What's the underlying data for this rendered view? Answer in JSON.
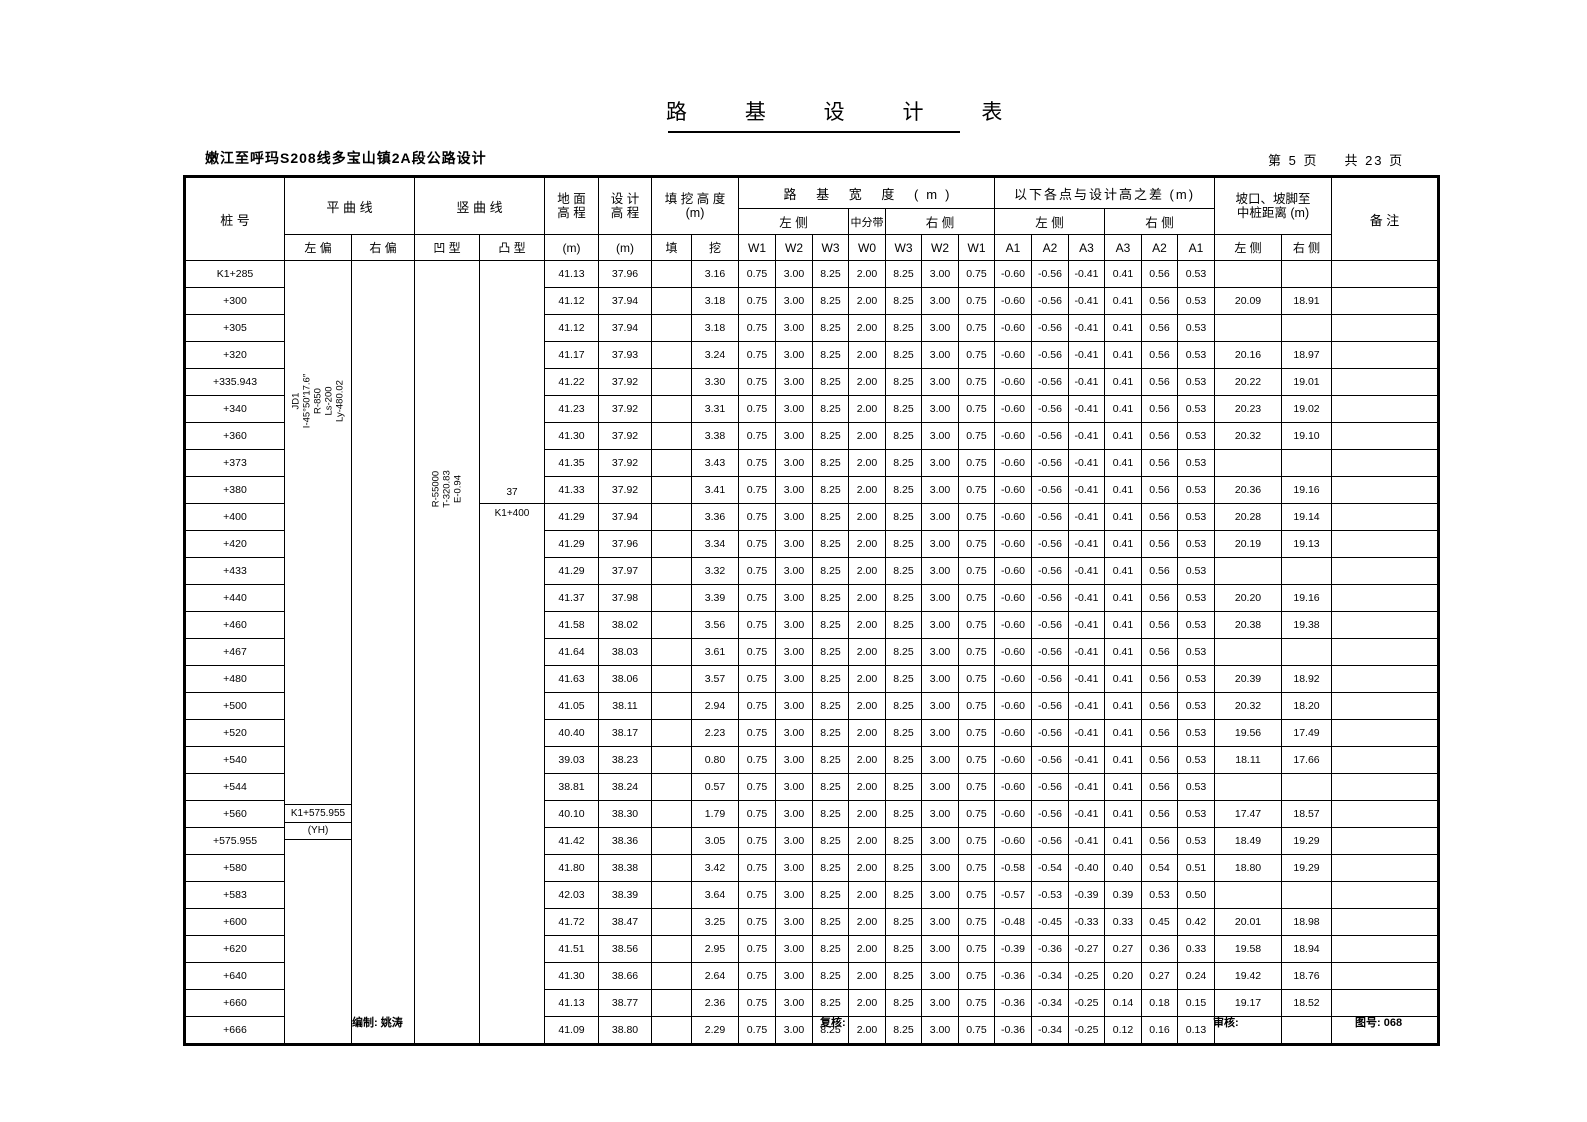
{
  "title": "路 基 设 计 表",
  "subtitle": "嫩江至呼玛S208线多宝山镇2A段公路设计",
  "page_info": {
    "page_label": "第 5 页",
    "total_label": "共 23 页"
  },
  "header": {
    "stake": "桩  号",
    "hcurve": "平  曲  线",
    "hcurve_left": "左 偏",
    "hcurve_right": "右 偏",
    "vcurve": "竖  曲  线",
    "vcurve_concave": "凹 型",
    "vcurve_convex": "凸 型",
    "ground_l1": "地  面",
    "ground_l2": "高  程",
    "ground_unit": "(m)",
    "design_l1": "设  计",
    "design_l2": "高  程",
    "design_unit": "(m)",
    "fillcut_l1": "填 挖 高 度",
    "fillcut_l2": "(m)",
    "fill": "填",
    "cut": "挖",
    "width_title": "路  基  宽  度  (m)",
    "side_left": "左  侧",
    "median": "中分带",
    "side_right": "右  侧",
    "w_labels": [
      "W1",
      "W2",
      "W3",
      "W0",
      "W3",
      "W2",
      "W1"
    ],
    "diff_title": "以下各点与设计高之差 (m)",
    "diff_left": "左  侧",
    "diff_right": "右  侧",
    "a_labels": [
      "A1",
      "A2",
      "A3",
      "A3",
      "A2",
      "A1"
    ],
    "slope_l1": "坡口、坡脚至",
    "slope_l2": "中桩距离 (m)",
    "slope_left": "左 侧",
    "slope_right": "右 侧",
    "remark": "备    注"
  },
  "annotations": {
    "hcurve_note": [
      "JD1",
      "I-45°50′17.6″",
      "R-850",
      "Ls-200",
      "Ly-480.02"
    ],
    "vcurve_note": [
      "R-55000",
      "T-320.83",
      "E-0.94"
    ],
    "convex_point": {
      "top": "37",
      "bottom": "K1+400"
    },
    "yh_point": {
      "top": "K1+575.955",
      "bottom": "(YH)"
    }
  },
  "w_common": [
    "0.75",
    "3.00",
    "8.25",
    "2.00",
    "8.25",
    "3.00",
    "0.75"
  ],
  "rows": [
    {
      "stake": "K1+285",
      "ground": "41.13",
      "design": "37.96",
      "fill": "",
      "cut": "3.16",
      "a": [
        "-0.60",
        "-0.56",
        "-0.41",
        "0.41",
        "0.56",
        "0.53"
      ],
      "dl": "",
      "dr": ""
    },
    {
      "stake": "+300",
      "ground": "41.12",
      "design": "37.94",
      "fill": "",
      "cut": "3.18",
      "a": [
        "-0.60",
        "-0.56",
        "-0.41",
        "0.41",
        "0.56",
        "0.53"
      ],
      "dl": "20.09",
      "dr": "18.91"
    },
    {
      "stake": "+305",
      "ground": "41.12",
      "design": "37.94",
      "fill": "",
      "cut": "3.18",
      "a": [
        "-0.60",
        "-0.56",
        "-0.41",
        "0.41",
        "0.56",
        "0.53"
      ],
      "dl": "",
      "dr": ""
    },
    {
      "stake": "+320",
      "ground": "41.17",
      "design": "37.93",
      "fill": "",
      "cut": "3.24",
      "a": [
        "-0.60",
        "-0.56",
        "-0.41",
        "0.41",
        "0.56",
        "0.53"
      ],
      "dl": "20.16",
      "dr": "18.97"
    },
    {
      "stake": "+335.943",
      "ground": "41.22",
      "design": "37.92",
      "fill": "",
      "cut": "3.30",
      "a": [
        "-0.60",
        "-0.56",
        "-0.41",
        "0.41",
        "0.56",
        "0.53"
      ],
      "dl": "20.22",
      "dr": "19.01"
    },
    {
      "stake": "+340",
      "ground": "41.23",
      "design": "37.92",
      "fill": "",
      "cut": "3.31",
      "a": [
        "-0.60",
        "-0.56",
        "-0.41",
        "0.41",
        "0.56",
        "0.53"
      ],
      "dl": "20.23",
      "dr": "19.02"
    },
    {
      "stake": "+360",
      "ground": "41.30",
      "design": "37.92",
      "fill": "",
      "cut": "3.38",
      "a": [
        "-0.60",
        "-0.56",
        "-0.41",
        "0.41",
        "0.56",
        "0.53"
      ],
      "dl": "20.32",
      "dr": "19.10"
    },
    {
      "stake": "+373",
      "ground": "41.35",
      "design": "37.92",
      "fill": "",
      "cut": "3.43",
      "a": [
        "-0.60",
        "-0.56",
        "-0.41",
        "0.41",
        "0.56",
        "0.53"
      ],
      "dl": "",
      "dr": ""
    },
    {
      "stake": "+380",
      "ground": "41.33",
      "design": "37.92",
      "fill": "",
      "cut": "3.41",
      "a": [
        "-0.60",
        "-0.56",
        "-0.41",
        "0.41",
        "0.56",
        "0.53"
      ],
      "dl": "20.36",
      "dr": "19.16"
    },
    {
      "stake": "+400",
      "ground": "41.29",
      "design": "37.94",
      "fill": "",
      "cut": "3.36",
      "a": [
        "-0.60",
        "-0.56",
        "-0.41",
        "0.41",
        "0.56",
        "0.53"
      ],
      "dl": "20.28",
      "dr": "19.14"
    },
    {
      "stake": "+420",
      "ground": "41.29",
      "design": "37.96",
      "fill": "",
      "cut": "3.34",
      "a": [
        "-0.60",
        "-0.56",
        "-0.41",
        "0.41",
        "0.56",
        "0.53"
      ],
      "dl": "20.19",
      "dr": "19.13"
    },
    {
      "stake": "+433",
      "ground": "41.29",
      "design": "37.97",
      "fill": "",
      "cut": "3.32",
      "a": [
        "-0.60",
        "-0.56",
        "-0.41",
        "0.41",
        "0.56",
        "0.53"
      ],
      "dl": "",
      "dr": ""
    },
    {
      "stake": "+440",
      "ground": "41.37",
      "design": "37.98",
      "fill": "",
      "cut": "3.39",
      "a": [
        "-0.60",
        "-0.56",
        "-0.41",
        "0.41",
        "0.56",
        "0.53"
      ],
      "dl": "20.20",
      "dr": "19.16"
    },
    {
      "stake": "+460",
      "ground": "41.58",
      "design": "38.02",
      "fill": "",
      "cut": "3.56",
      "a": [
        "-0.60",
        "-0.56",
        "-0.41",
        "0.41",
        "0.56",
        "0.53"
      ],
      "dl": "20.38",
      "dr": "19.38"
    },
    {
      "stake": "+467",
      "ground": "41.64",
      "design": "38.03",
      "fill": "",
      "cut": "3.61",
      "a": [
        "-0.60",
        "-0.56",
        "-0.41",
        "0.41",
        "0.56",
        "0.53"
      ],
      "dl": "",
      "dr": ""
    },
    {
      "stake": "+480",
      "ground": "41.63",
      "design": "38.06",
      "fill": "",
      "cut": "3.57",
      "a": [
        "-0.60",
        "-0.56",
        "-0.41",
        "0.41",
        "0.56",
        "0.53"
      ],
      "dl": "20.39",
      "dr": "18.92"
    },
    {
      "stake": "+500",
      "ground": "41.05",
      "design": "38.11",
      "fill": "",
      "cut": "2.94",
      "a": [
        "-0.60",
        "-0.56",
        "-0.41",
        "0.41",
        "0.56",
        "0.53"
      ],
      "dl": "20.32",
      "dr": "18.20"
    },
    {
      "stake": "+520",
      "ground": "40.40",
      "design": "38.17",
      "fill": "",
      "cut": "2.23",
      "a": [
        "-0.60",
        "-0.56",
        "-0.41",
        "0.41",
        "0.56",
        "0.53"
      ],
      "dl": "19.56",
      "dr": "17.49"
    },
    {
      "stake": "+540",
      "ground": "39.03",
      "design": "38.23",
      "fill": "",
      "cut": "0.80",
      "a": [
        "-0.60",
        "-0.56",
        "-0.41",
        "0.41",
        "0.56",
        "0.53"
      ],
      "dl": "18.11",
      "dr": "17.66"
    },
    {
      "stake": "+544",
      "ground": "38.81",
      "design": "38.24",
      "fill": "",
      "cut": "0.57",
      "a": [
        "-0.60",
        "-0.56",
        "-0.41",
        "0.41",
        "0.56",
        "0.53"
      ],
      "dl": "",
      "dr": ""
    },
    {
      "stake": "+560",
      "ground": "40.10",
      "design": "38.30",
      "fill": "",
      "cut": "1.79",
      "a": [
        "-0.60",
        "-0.56",
        "-0.41",
        "0.41",
        "0.56",
        "0.53"
      ],
      "dl": "17.47",
      "dr": "18.57"
    },
    {
      "stake": "+575.955",
      "ground": "41.42",
      "design": "38.36",
      "fill": "",
      "cut": "3.05",
      "a": [
        "-0.60",
        "-0.56",
        "-0.41",
        "0.41",
        "0.56",
        "0.53"
      ],
      "dl": "18.49",
      "dr": "19.29"
    },
    {
      "stake": "+580",
      "ground": "41.80",
      "design": "38.38",
      "fill": "",
      "cut": "3.42",
      "a": [
        "-0.58",
        "-0.54",
        "-0.40",
        "0.40",
        "0.54",
        "0.51"
      ],
      "dl": "18.80",
      "dr": "19.29"
    },
    {
      "stake": "+583",
      "ground": "42.03",
      "design": "38.39",
      "fill": "",
      "cut": "3.64",
      "a": [
        "-0.57",
        "-0.53",
        "-0.39",
        "0.39",
        "0.53",
        "0.50"
      ],
      "dl": "",
      "dr": ""
    },
    {
      "stake": "+600",
      "ground": "41.72",
      "design": "38.47",
      "fill": "",
      "cut": "3.25",
      "a": [
        "-0.48",
        "-0.45",
        "-0.33",
        "0.33",
        "0.45",
        "0.42"
      ],
      "dl": "20.01",
      "dr": "18.98"
    },
    {
      "stake": "+620",
      "ground": "41.51",
      "design": "38.56",
      "fill": "",
      "cut": "2.95",
      "a": [
        "-0.39",
        "-0.36",
        "-0.27",
        "0.27",
        "0.36",
        "0.33"
      ],
      "dl": "19.58",
      "dr": "18.94"
    },
    {
      "stake": "+640",
      "ground": "41.30",
      "design": "38.66",
      "fill": "",
      "cut": "2.64",
      "a": [
        "-0.36",
        "-0.34",
        "-0.25",
        "0.20",
        "0.27",
        "0.24"
      ],
      "dl": "19.42",
      "dr": "18.76"
    },
    {
      "stake": "+660",
      "ground": "41.13",
      "design": "38.77",
      "fill": "",
      "cut": "2.36",
      "a": [
        "-0.36",
        "-0.34",
        "-0.25",
        "0.14",
        "0.18",
        "0.15"
      ],
      "dl": "19.17",
      "dr": "18.52"
    },
    {
      "stake": "+666",
      "ground": "41.09",
      "design": "38.80",
      "fill": "",
      "cut": "2.29",
      "a": [
        "-0.36",
        "-0.34",
        "-0.25",
        "0.12",
        "0.16",
        "0.13"
      ],
      "dl": "",
      "dr": ""
    }
  ],
  "footer": {
    "prepared": "编制: 姚涛",
    "checked": "复核:",
    "reviewed": "审核:",
    "drawing_no": "图号: 068"
  }
}
